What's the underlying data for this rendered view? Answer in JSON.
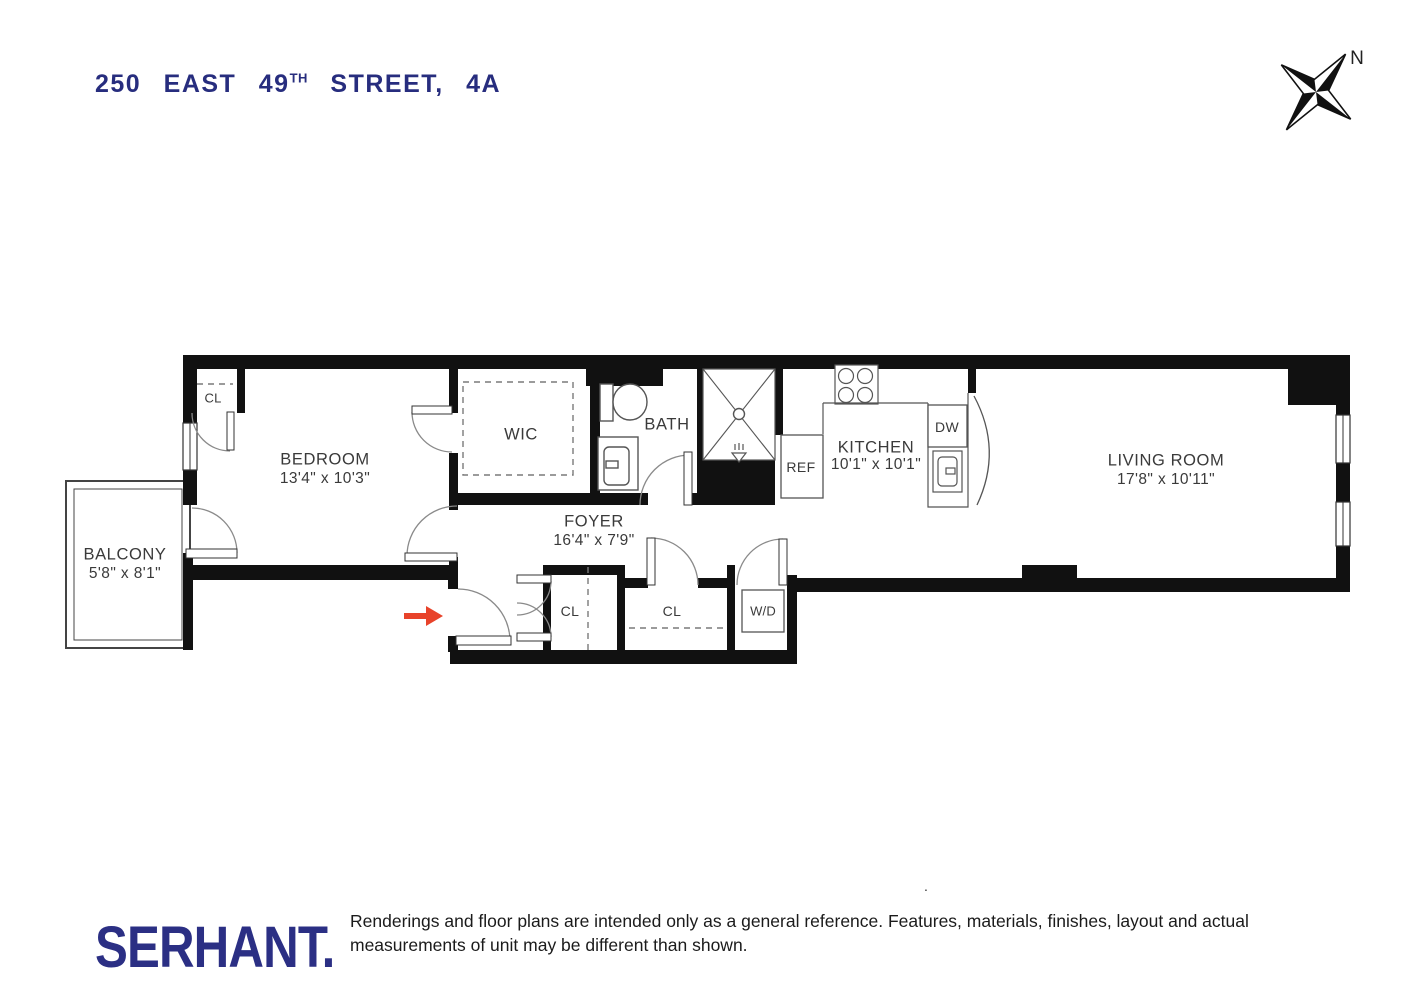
{
  "title": {
    "part1": "250 EAST 49",
    "superscript": "TH",
    "part2": "STREET, 4A"
  },
  "compass": {
    "north_label": "N"
  },
  "plan": {
    "rooms": [
      {
        "id": "balcony",
        "label": "BALCONY",
        "dims": "5'8\" x 8'1\""
      },
      {
        "id": "bedroom",
        "label": "BEDROOM",
        "dims": "13'4\" x 10'3\""
      },
      {
        "id": "wic",
        "label": "WIC",
        "dims": ""
      },
      {
        "id": "bath",
        "label": "BATH",
        "dims": ""
      },
      {
        "id": "foyer",
        "label": "FOYER",
        "dims": "16'4\" x 7'9\""
      },
      {
        "id": "kitchen",
        "label": "KITCHEN",
        "dims": "10'1\" x 10'1\""
      },
      {
        "id": "living_room",
        "label": "LIVING ROOM",
        "dims": "17'8\" x 10'11\""
      }
    ],
    "closets": {
      "bedroom_closet": "CL",
      "foyer_closet_1": "CL",
      "foyer_closet_2": "CL",
      "washer_dryer": "W/D"
    },
    "appliances": {
      "dishwasher": "DW",
      "refrigerator": "REF"
    }
  },
  "footer": {
    "brand": "SERHANT.",
    "disclaimer": "Renderings and floor plans are intended only as a general reference. Features, materials, finishes, layout and actual measurements of unit may be different than shown.",
    "stray_dot": "."
  },
  "colors": {
    "brand_navy": "#272d7e",
    "wall_black": "#111111",
    "fixture_gray": "#555555",
    "door_arc_gray": "#888888",
    "entry_arrow_red": "#e8432a",
    "label_gray": "#3a3a3a"
  }
}
